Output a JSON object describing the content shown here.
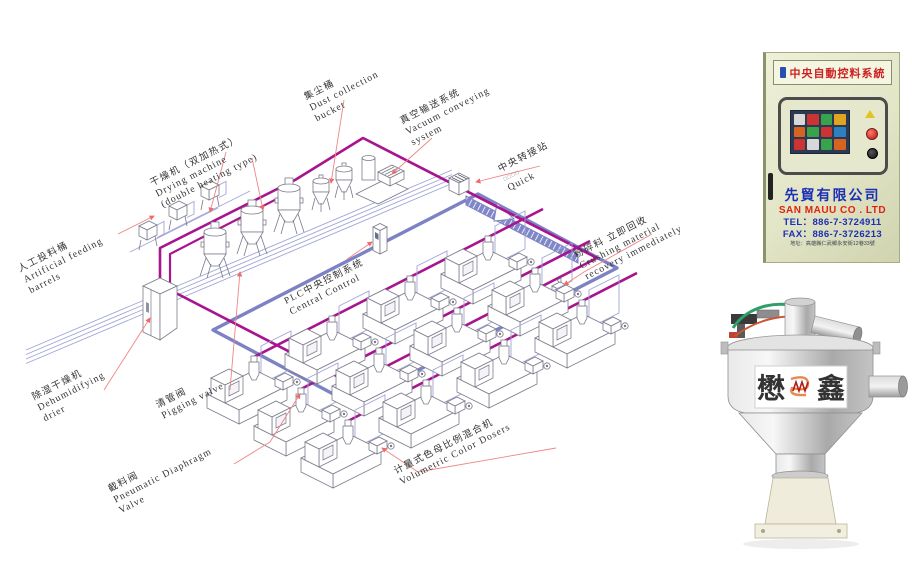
{
  "diagram": {
    "labels": {
      "feeding": {
        "zh": "人工投料桶",
        "en1": "Artificial feeding",
        "en2": "barrels"
      },
      "drying": {
        "zh": "干燥机（双加热式）",
        "en1": "Drying machine",
        "en2": "(double heating type)"
      },
      "dust": {
        "zh": "集尘桶",
        "en1": "Dust collection",
        "en2": "bucket"
      },
      "vacuum": {
        "zh": "真空输送系统",
        "en1": "Vacuum conveying",
        "en2": "system"
      },
      "transfer": {
        "zh": "中央转接站",
        "sub": "□□□□",
        "en1": "Quick"
      },
      "dehumidifier": {
        "zh": "除湿干燥机",
        "en1": "Dehumidifying",
        "en2": "drier"
      },
      "pigging": {
        "zh": "清管阀",
        "en1": "Pigging valve"
      },
      "plc": {
        "zh": "PLC中央控制系统",
        "en1": "Central Control"
      },
      "crushing": {
        "zh": "粉碎料 立即回收",
        "en1": "Crushing material",
        "en2": "recovery immediately"
      },
      "diaphragm": {
        "zh": "截料阀",
        "en1": "Pneumatic Diaphragm",
        "en2": "Valve"
      },
      "doser": {
        "zh": "计量式色母比例混合机",
        "en1": "Volumetric Color Dosers"
      }
    },
    "colors": {
      "pipe_magenta": "#a8148e",
      "pipe_blue": "#7d82c4",
      "leader_red": "#ef8585"
    }
  },
  "cabinet": {
    "header": "中央自動控料系統",
    "company_zh": "先貿有限公司",
    "company_en": "SAN MAUU CO . LTD",
    "tel": "TEL：886-7-3724911",
    "fax": "FAX：886-7-3726213",
    "address": "地址：高雄縣仁武鄉永安街12巷33號",
    "colors": {
      "body": "#e4e7cb",
      "company_blue": "#1d2fb5",
      "company_red": "#e02211"
    }
  },
  "hopper": {
    "brand_left": "懋",
    "brand_right": "鑫",
    "brand_color": "#e03224"
  }
}
